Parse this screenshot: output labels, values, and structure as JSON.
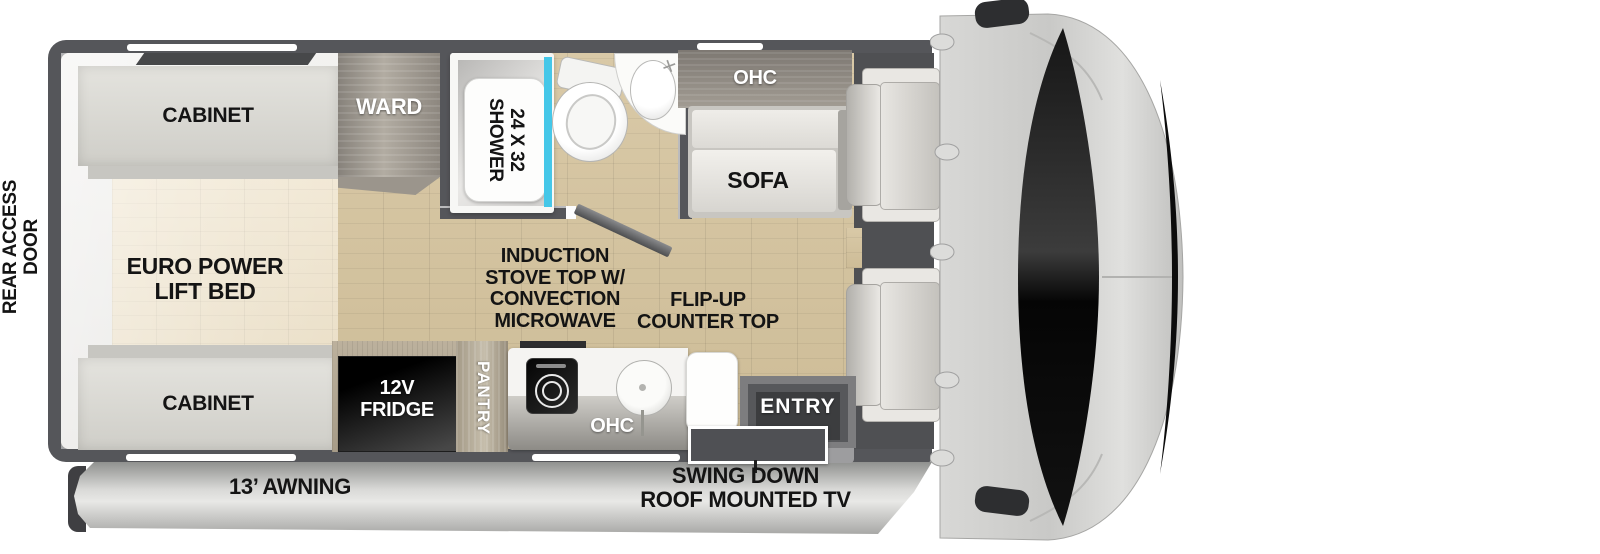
{
  "type": "rv-floorplan-diagram",
  "colors": {
    "wall": "#55565a",
    "floor_wood": "#d5c4a2",
    "bed_floor": "#efe5d0",
    "cabinet": "#dcdbd6",
    "ward_wood": "#9a948b",
    "shower_glass": "#45c7e8",
    "fridge": "#0a0a0a",
    "awning": "#c9c9c7",
    "cab_body": "#cfcfcd",
    "windshield": "#111111",
    "label_dark": "#141414",
    "label_light": "#ffffff"
  },
  "exterior": {
    "rear_access_door": "REAR ACCESS\nDOOR",
    "awning": "13’ AWNING",
    "tv_note": "SWING DOWN\nROOF MOUNTED TV"
  },
  "bedroom": {
    "cabinet_top": "CABINET",
    "bed": "EURO POWER\nLIFT BED",
    "cabinet_bottom": "CABINET",
    "ward": "WARD"
  },
  "bathroom": {
    "shower": "24 X 32\nSHOWER"
  },
  "living": {
    "ohc": "OHC",
    "sofa": "SOFA"
  },
  "kitchen": {
    "fridge": "12V\nFRIDGE",
    "pantry": "PANTRY",
    "ohc": "OHC",
    "induction_note": "INDUCTION\nSTOVE TOP W/\nCONVECTION\nMICROWAVE",
    "flip_up_note": "FLIP-UP\nCOUNTER TOP",
    "entry": "ENTRY"
  }
}
